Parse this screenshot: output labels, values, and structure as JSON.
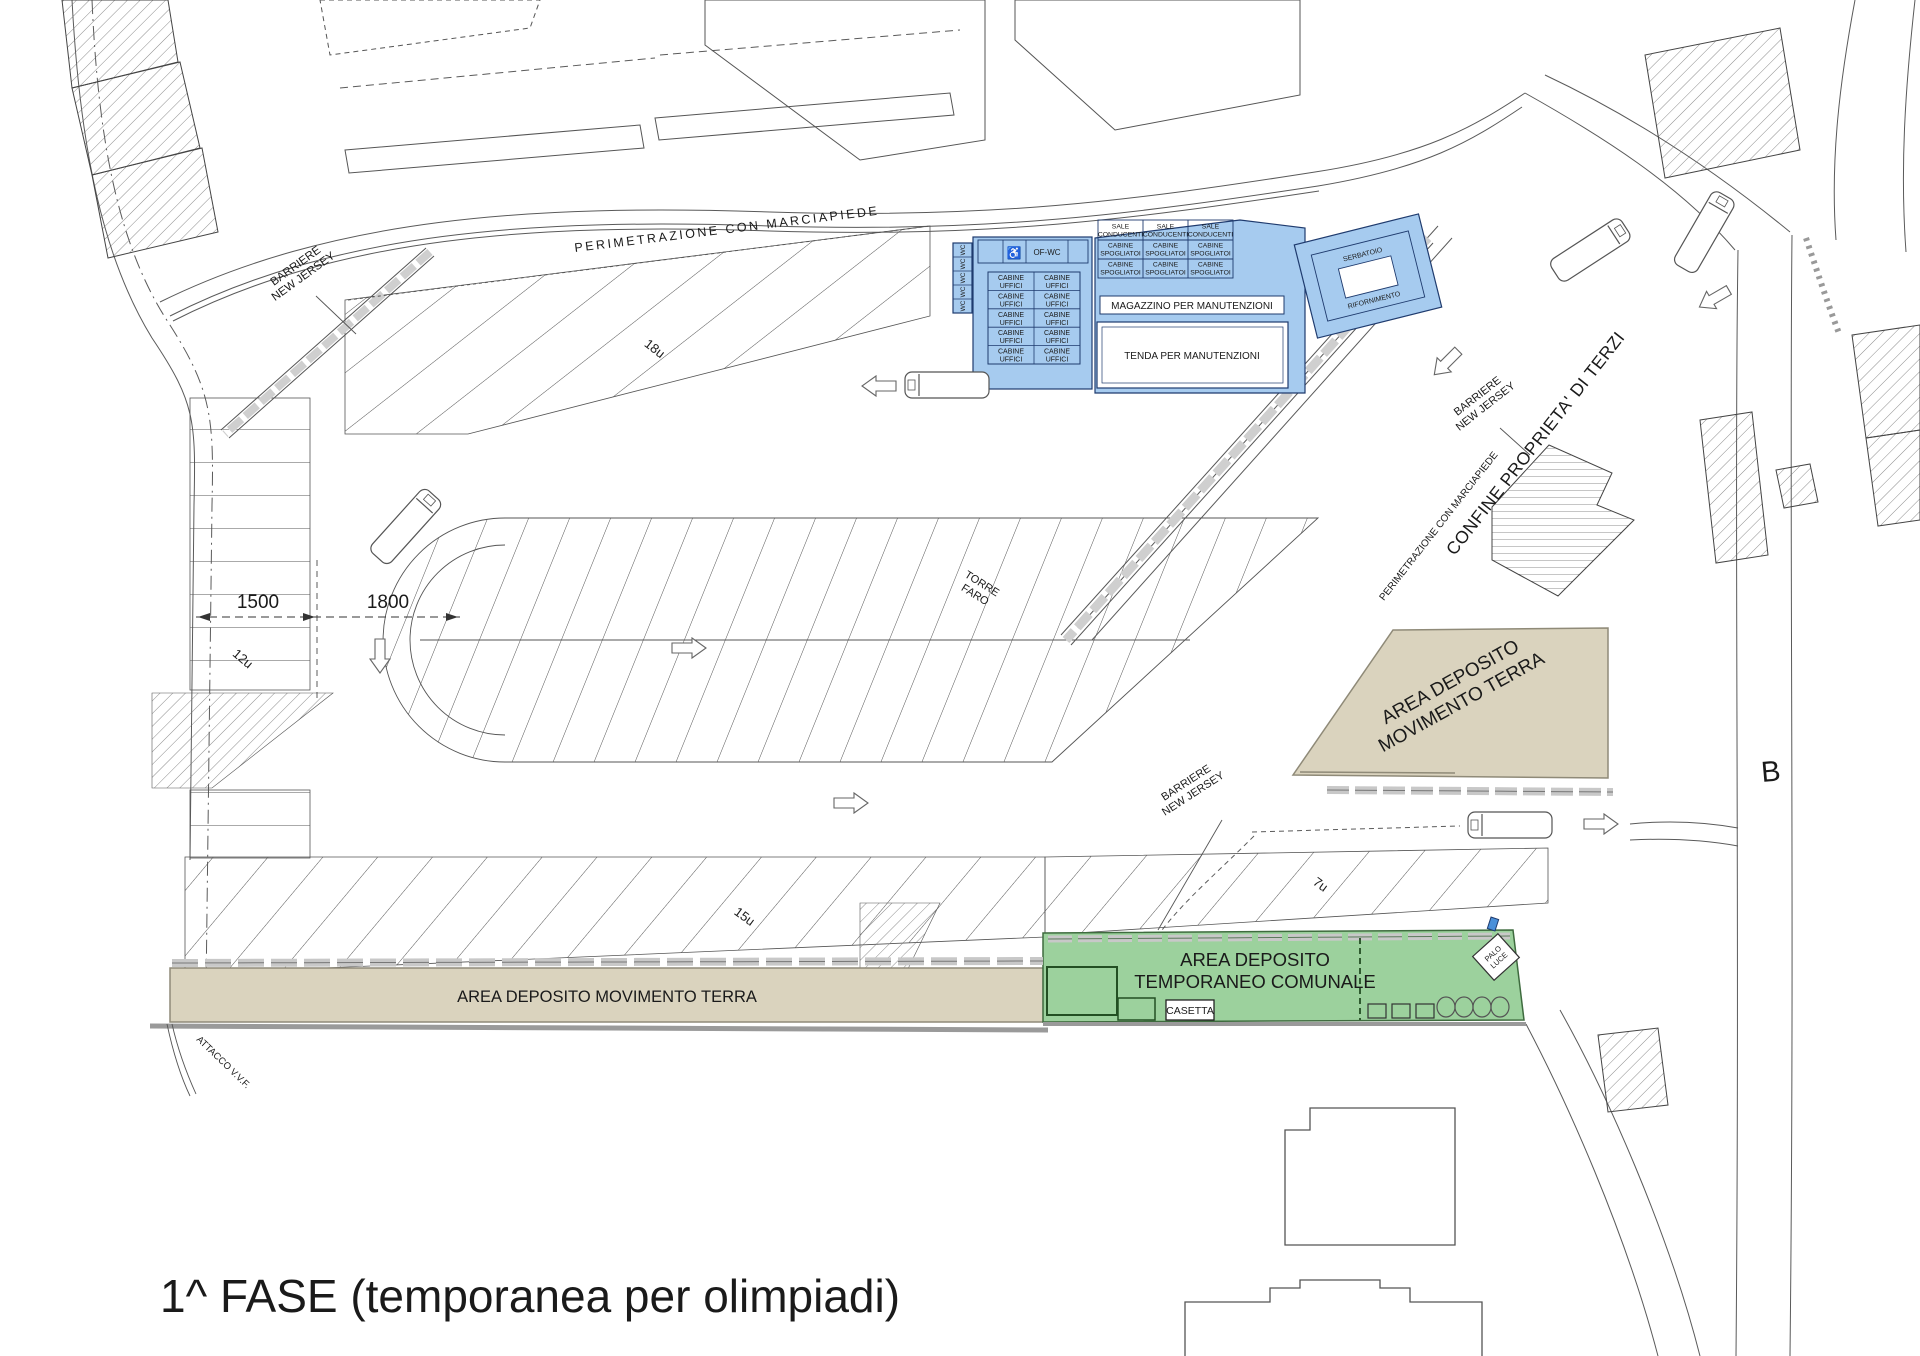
{
  "title": "1^ FASE (temporanea per olimpiadi)",
  "plan_marker": "B",
  "roads": {
    "perimetrazione_top": "PERIMETRAZIONE CON MARCIAPIEDE",
    "perimetrazione_right": "PERIMETRAZIONE CON MARCIAPIEDE",
    "confine_terzi": "CONFINE PROPRIETA' DI TERZI",
    "barriere_line1": "BARRIERE",
    "barriere_line2": "NEW JERSEY",
    "attacco_vvf": "ATTACCO V.V.F."
  },
  "dims": {
    "d1500": "1500",
    "d1800": "1800"
  },
  "stalls": {
    "s18": "18u",
    "s12": "12u",
    "s15": "15u",
    "s7": "7u"
  },
  "fac": {
    "wc": "WC",
    "of_wc": "OF-WC",
    "wheelchair_icon": "♿",
    "cab_l1": "CABINE",
    "cab_l2": "UFFICI",
    "sale_l1": "SALE",
    "sale_l2": "CONDUCENTI",
    "spog_l1": "CABINE",
    "spog_l2": "SPOGLIATOI",
    "magazzino": "MAGAZZINO PER MANUTENZIONI",
    "tenda": "TENDA PER MANUTENZIONI",
    "serb_l1": "SERBATOIO",
    "serb_l2": "RIFORNIMENTO",
    "torre_l1": "TORRE",
    "torre_l2": "FARO",
    "palo_l1": "PALO",
    "palo_l2": "LUCE",
    "casetta": "CASETTA"
  },
  "areas": {
    "dep_right_l1": "AREA DEPOSITO",
    "dep_right_l2": "MOVIMENTO TERRA",
    "dep_bottom": "AREA DEPOSITO MOVIMENTO TERRA",
    "temp_l1": "AREA DEPOSITO",
    "temp_l2": "TEMPORANEO COMUNALE"
  },
  "colors": {
    "blue_fill": "#A6CBEF",
    "blue_border": "#1F3B6E",
    "tan_fill": "#DAD3BE",
    "tan_border": "#8F8A78",
    "green_fill": "#9CD19D",
    "green_border": "#3E6B3E",
    "line_dark": "#3F3F3F",
    "barrier_gray": "#C8C8C8"
  }
}
